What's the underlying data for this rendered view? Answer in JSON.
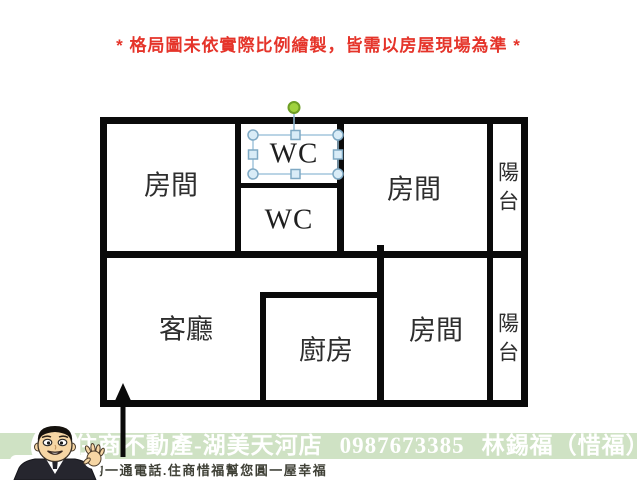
{
  "disclaimer": "* 格局圖未依實際比例繪製，皆需以房屋現場為準 *",
  "floorplan": {
    "rooms": {
      "bedroom_top_left": "房間",
      "wc_upper": "WC",
      "wc_lower": "WC",
      "bedroom_top_right": "房間",
      "balcony_top": "陽台",
      "living_room": "客廳",
      "kitchen": "廚房",
      "bedroom_bottom_right": "房間",
      "balcony_bottom": "陽台"
    },
    "editor_selection": {
      "selected_object": "wc_upper"
    }
  },
  "banner": {
    "store_name": "住商不動產-湖美天河店",
    "phone": "0987673385",
    "agent_name": "林錫福（惜福）",
    "slogan": "您的一通電話.住商惜福幫您圓一屋幸福"
  },
  "icons": {
    "avatar": "agent-cartoon-avatar",
    "entrance_arrow": "entrance-arrow",
    "rotation_handle": "rotation-handle-green-dot"
  },
  "colors": {
    "disclaimer_red": "#e5342a",
    "wall": "#0a0a0a",
    "banner_green": "#cfe2c4",
    "banner_text": "#ffffff",
    "slogan_text": "#3f4036",
    "selection_stroke": "#9cc2da",
    "handle_fill": "#d9ecf7",
    "rotation_green": "#a0d23f"
  }
}
